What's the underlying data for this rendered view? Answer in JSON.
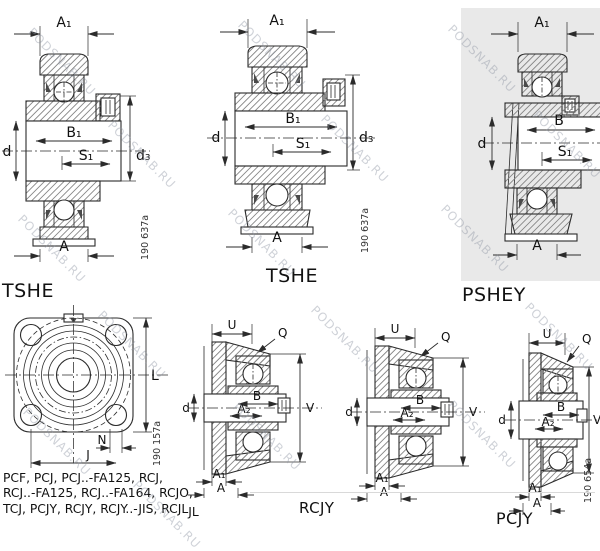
{
  "watermark": "PODSNAB.RU",
  "captions": {
    "tshe1": "TSHE",
    "tshe2": "TSHE",
    "pshey": "PSHEY",
    "rcjy": "RCJY",
    "pcjy": "PCJY"
  },
  "numbers": {
    "tshe1": "190 637a",
    "tshe2": "190 637a",
    "flange": "190 157a",
    "pcjy": "190 654a"
  },
  "dims": {
    "tshe1": {
      "a1": "A₁",
      "b1": "B₁",
      "d": "d",
      "d3": "d₃",
      "s1": "S₁",
      "a": "A"
    },
    "tshe2": {
      "a1": "A₁",
      "b1": "B₁",
      "d": "d",
      "d3": "d₃",
      "s1": "S₁",
      "a": "A"
    },
    "pshey": {
      "a1": "A₁",
      "b": "B",
      "d": "d",
      "s1": "S₁",
      "a": "A"
    },
    "flange": {
      "l": "L",
      "n": "N",
      "j": "J"
    },
    "rcjy1": {
      "u": "U",
      "q": "Q",
      "b": "B",
      "d": "d",
      "a2": "A₂",
      "v": "V",
      "a1": "A₁",
      "a": "A"
    },
    "rcjy2": {
      "u": "U",
      "q": "Q",
      "b": "B",
      "d": "d",
      "a2": "A₂",
      "v": "V",
      "a1": "A₁",
      "a": "A"
    },
    "pcjy": {
      "u": "U",
      "q": "Q",
      "b": "B",
      "d": "d",
      "a2": "A₂",
      "v": "V",
      "a1": "A₁",
      "a": "A"
    }
  },
  "series_list": {
    "line1": "PCF, PCJ, PCJ..-FA125, RCJ,",
    "line2": "RCJ..-FA125, RCJ..-FA164, RCJO,",
    "line3": "TCJ, PCJY, RCJY, RCJY..-JIS, RCJL",
    "line3_suffix": "JL"
  }
}
